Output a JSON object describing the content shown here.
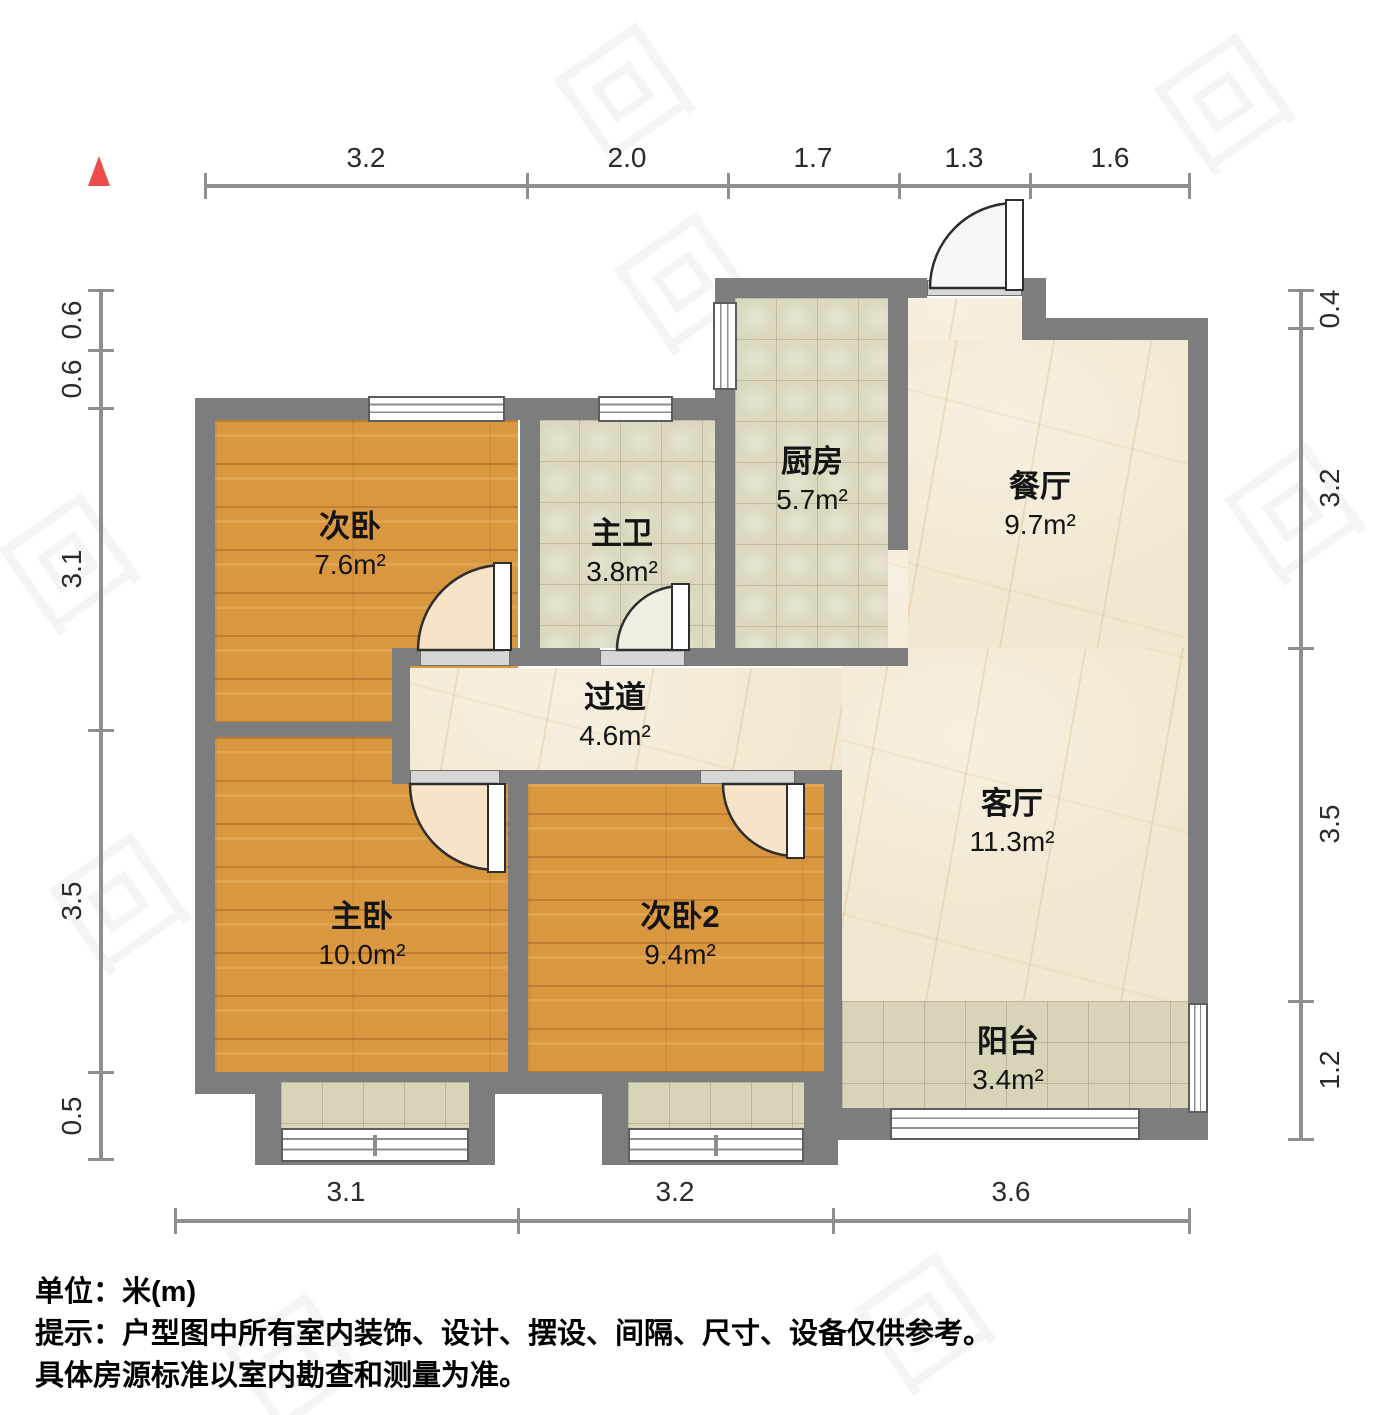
{
  "rooms": [
    {
      "id": "bedroom2",
      "name": "次卧",
      "area": "7.6m²"
    },
    {
      "id": "bath",
      "name": "主卫",
      "area": "3.8m²"
    },
    {
      "id": "kitchen",
      "name": "厨房",
      "area": "5.7m²"
    },
    {
      "id": "dining",
      "name": "餐厅",
      "area": "9.7m²"
    },
    {
      "id": "hallway",
      "name": "过道",
      "area": "4.6m²"
    },
    {
      "id": "master",
      "name": "主卧",
      "area": "10.0m²"
    },
    {
      "id": "bedroom3",
      "name": "次卧2",
      "area": "9.4m²"
    },
    {
      "id": "living",
      "name": "客厅",
      "area": "11.3m²"
    },
    {
      "id": "balcony",
      "name": "阳台",
      "area": "3.4m²"
    }
  ],
  "dimensions": {
    "top": [
      "3.2",
      "2.0",
      "1.7",
      "1.3",
      "1.6"
    ],
    "left": [
      "0.6",
      "0.6",
      "3.1",
      "3.5",
      "0.5"
    ],
    "right": [
      "0.4",
      "3.2",
      "3.5",
      "1.2"
    ],
    "bottom": [
      "3.1",
      "3.2",
      "3.6"
    ]
  },
  "notes": {
    "unit": "单位：米(m)",
    "tip": "提示：户型图中所有室内装饰、设计、摆设、间隔、尺寸、设备仅供参考。",
    "tip2": "具体房源标准以室内勘查和测量为准。"
  },
  "watermark": {
    "glyph": "回"
  },
  "colors": {
    "wall": "#7d7d7d",
    "wood": "#d99840",
    "tile": "#dbd8bf",
    "marble": "#f2e8d1",
    "north": "#ee4c4c"
  }
}
